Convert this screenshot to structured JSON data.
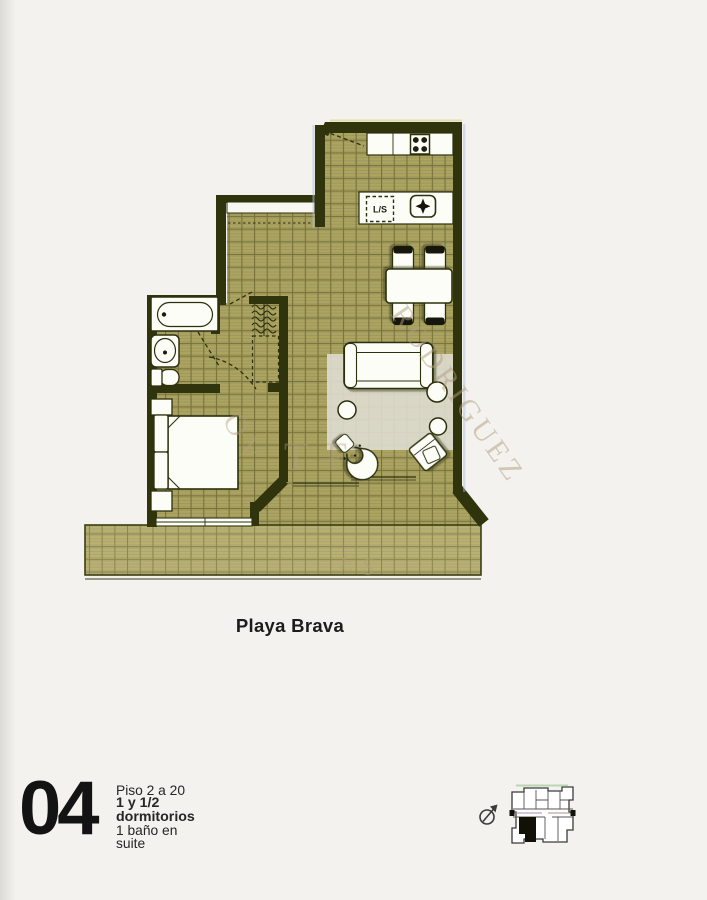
{
  "document": {
    "type_label": "apartment floor plan sheet",
    "plan_title": "Playa Brava",
    "unit": {
      "number": "04",
      "floors": "Piso 2 a 20",
      "rooms": "1 y 1/2 dormitorios",
      "bath": "1 baño en suite"
    }
  },
  "plan": {
    "labels": {
      "washer_dryer": "L/S"
    },
    "rooms": [
      "cocina",
      "comedor",
      "living",
      "dormitorio",
      "baño en suite",
      "closet",
      "hall",
      "terraza"
    ],
    "watermark": {
      "main": "RODRIGUEZ",
      "fragment_bed": "OV",
      "fragment_mid": "TF",
      "fragment_terrace": "ES"
    },
    "colors": {
      "wall": "#30340d",
      "floor": "#ada55d",
      "floor_grid": "#77723a",
      "terrace": "#bab26c",
      "terrace_grid": "#8a8548",
      "fixture_fill": "#fdfdf8",
      "fixture_outline": "#2c300c",
      "rug": "#e0ded4",
      "watermark": "#b29e7f",
      "text": "#1c1c1c",
      "fringe_blue": "#aebedd",
      "fringe_yellow": "#d8d27a"
    }
  },
  "keyplan": {
    "description": "building key plan, unit 04 highlighted black",
    "highlighted_unit": "04"
  }
}
